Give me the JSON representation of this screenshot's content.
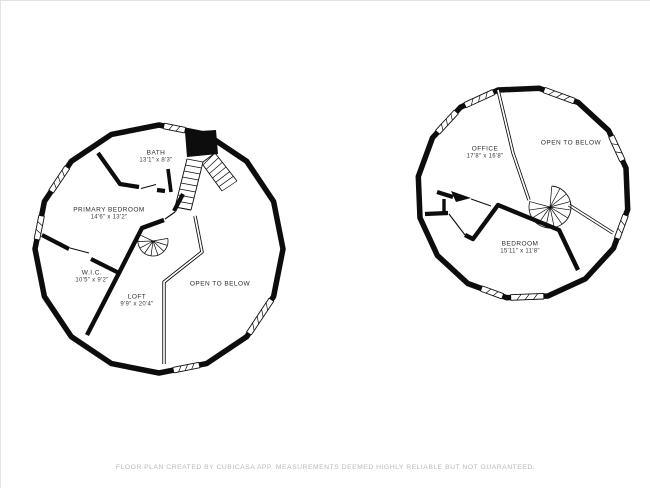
{
  "page": {
    "footer": "FLOOR PLAN CREATED BY CUBICASA APP. MEASUREMENTS DEEMED HIGHLY RELIABLE BUT NOT GUARANTEED."
  },
  "colors": {
    "wall": "#0d0d0d",
    "label_text": "#2e2e2e",
    "footer_text": "#b9b9b9",
    "background": "#ffffff"
  },
  "plans": [
    {
      "name": "left-floor-plan",
      "rooms": [
        {
          "label": "BATH",
          "dims": "13'1\" x 8'3\""
        },
        {
          "label": "PRIMARY BEDROOM",
          "dims": "14'6\" x 13'2\""
        },
        {
          "label": "W.I.C.",
          "dims": "10'5\" x 9'2\""
        },
        {
          "label": "LOFT",
          "dims": "9'9\" x 20'4\""
        },
        {
          "label": "OPEN TO BELOW",
          "dims": ""
        }
      ]
    },
    {
      "name": "right-floor-plan",
      "rooms": [
        {
          "label": "OFFICE",
          "dims": "17'8\" x 16'8\""
        },
        {
          "label": "OPEN TO BELOW",
          "dims": ""
        },
        {
          "label": "BEDROOM",
          "dims": "15'11\" x 11'8\""
        }
      ]
    }
  ]
}
